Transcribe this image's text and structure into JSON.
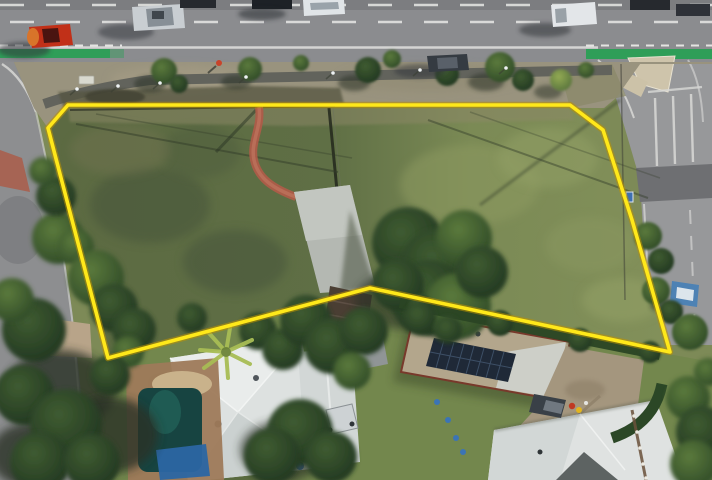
{
  "scene": {
    "kind": "aerial-drone-photograph",
    "subject": "vacant-corner-land-parcel-outlined-for-sale",
    "features": [
      "main-road-with-traffic",
      "green-bike-lanes",
      "side-street-intersection",
      "grass-parcel-with-yellow-boundary",
      "red-garden-path",
      "concrete-pad",
      "neighbouring-houses",
      "swimming-pool",
      "solar-panel-roof",
      "tree-cover"
    ]
  },
  "boundary": {
    "points": "68,105 570,105 603,130 632,220 670,352 370,288 108,358 48,128",
    "stroke_color": "#ffe81a",
    "halo_color": "#bb9200"
  },
  "palette": {
    "road_asphalt": "#8b8c8f",
    "side_street_asphalt": "#97989a",
    "bike_lane_green": "#2f9e58",
    "lane_marking": "#e8e8e6",
    "verge_dry_grass": "#99937e",
    "parcel_grass_dark": "#5c6a42",
    "parcel_grass_light": "#82905a",
    "tree_canopy_dark": "#1f3420",
    "footpath_asphalt": "#62635c",
    "garden_path_red": "#ad5c49",
    "concrete_pad": "#b4b8b2",
    "roof_white": "#dde1e0",
    "roof_tan": "#b3a68c",
    "solar_panel": "#1f2937",
    "pool_water": "#174441",
    "pool_tarp": "#2b66a3",
    "traffic_island": "#cec4ab",
    "car_red": "#c13018",
    "car_silver": "#c9ced2",
    "car_white_van": "#e3e6e9",
    "car_dark": "#353b42",
    "car_blue": "#4e82b4"
  },
  "vehicles": [
    "red-hatchback",
    "silver-sedan",
    "white-suv",
    "white-van",
    "dark-sedan-parked",
    "dark-cars-top-edge",
    "blue-car-parked-side-street",
    "dark-ute-backyard"
  ]
}
